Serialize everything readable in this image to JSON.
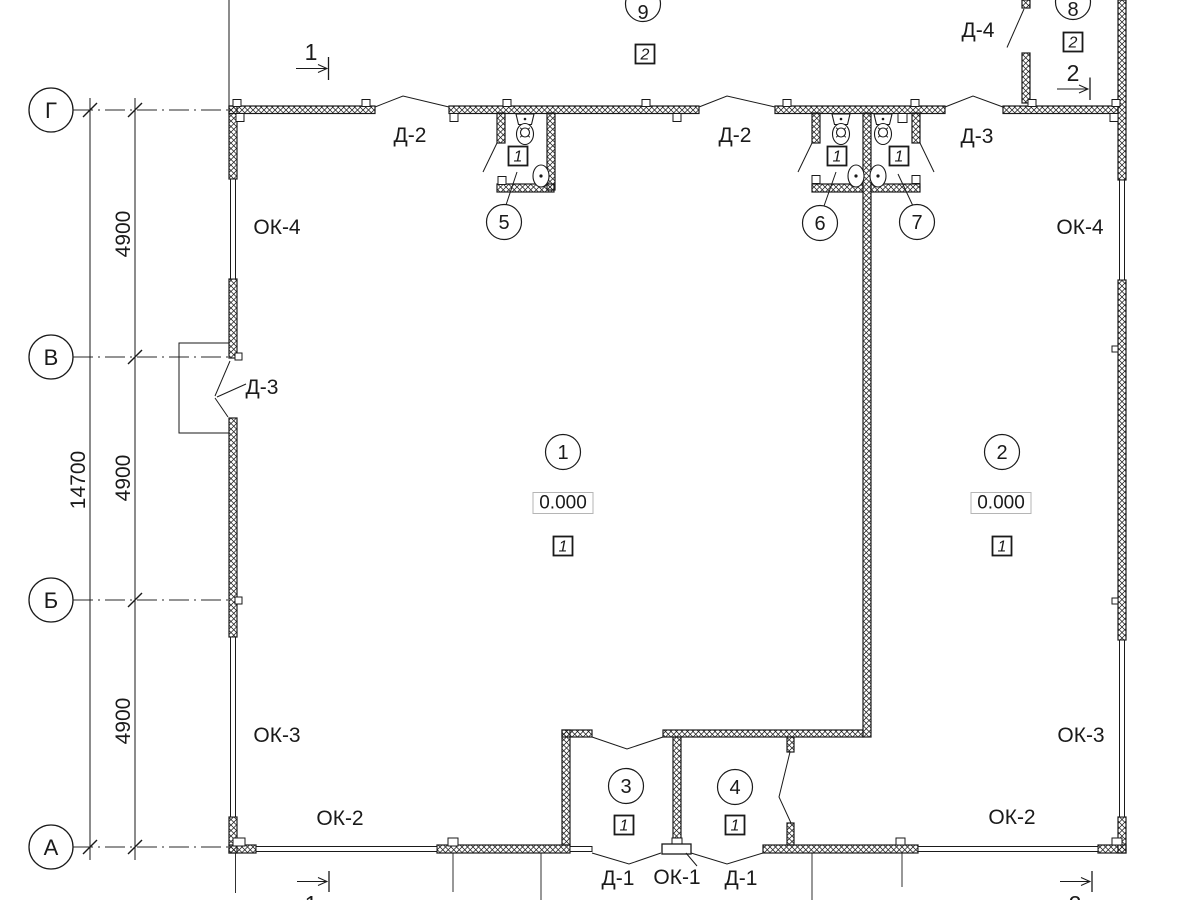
{
  "plan": {
    "axes": [
      {
        "label": "Г"
      },
      {
        "label": "В"
      },
      {
        "label": "Б"
      },
      {
        "label": "А"
      }
    ],
    "dimensions": {
      "total": "14700",
      "segments": [
        "4900",
        "4900",
        "4900"
      ]
    },
    "rooms": [
      {
        "number": "1",
        "elevation": "0.000",
        "floor": "1"
      },
      {
        "number": "2",
        "elevation": "0.000",
        "floor": "1"
      },
      {
        "number": "3",
        "floor": "1"
      },
      {
        "number": "4",
        "floor": "1"
      },
      {
        "number": "5",
        "floor": "1"
      },
      {
        "number": "6",
        "floor": "1"
      },
      {
        "number": "7",
        "floor": "1"
      },
      {
        "number": "8",
        "floor": "2"
      },
      {
        "number": "9",
        "floor": "2"
      }
    ],
    "doors": {
      "d2_left": "Д-2",
      "d2_right": "Д-2",
      "d3_top": "Д-3",
      "d4": "Д-4",
      "d3_left": "Д-3",
      "d1_left": "Д-1",
      "d1_right": "Д-1"
    },
    "windows": {
      "ok1": "ОК-1",
      "ok2_left": "ОК-2",
      "ok2_right": "ОК-2",
      "ok3_left": "ОК-3",
      "ok3_right": "ОК-3",
      "ok4_left": "ОК-4",
      "ok4_right": "ОК-4"
    },
    "sections": {
      "s1": "1",
      "s2": "2"
    }
  }
}
